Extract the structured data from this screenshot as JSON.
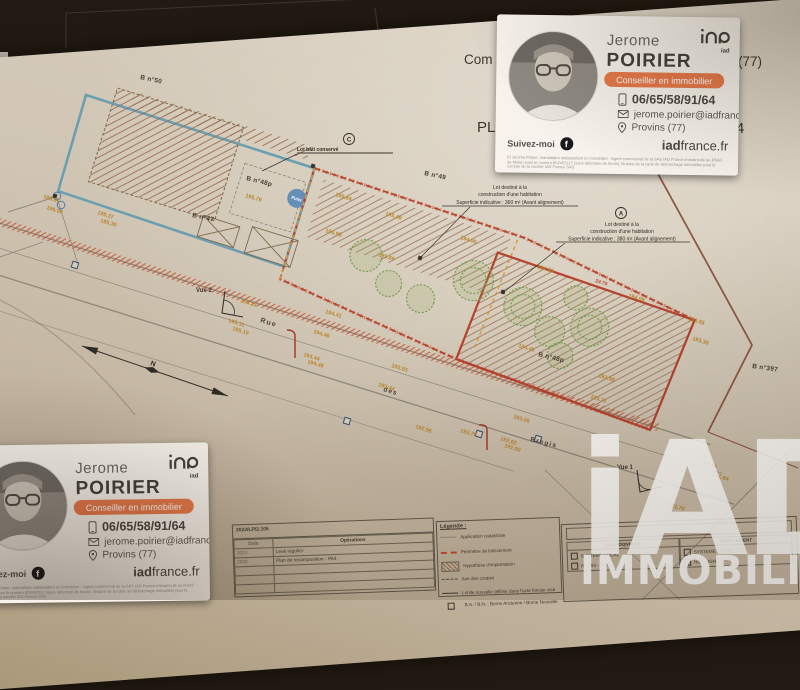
{
  "title_fragments": {
    "com": "Com",
    "dept": "(77)",
    "pl": "PL",
    "num": "4"
  },
  "plan": {
    "parcels": {
      "b50": "B n°50",
      "b47": "B n°47",
      "b48p_left": "B n°48p",
      "b49": "B n°49",
      "b48p_right": "B n°48p",
      "b397": "B n°397"
    },
    "labels": {
      "conserved": "Lot bâti conservé",
      "c_marker": "C",
      "a_marker": "A",
      "lotB1": "Lot destiné à la",
      "lotB2": "construction d'une habitation",
      "lotB3": "Superficie indicative : 360 m² (Avant alignement)",
      "lotA1": "Lot destiné à la",
      "lotA2": "construction d'une habitation",
      "lotA3": "Superficie indicative : 380 m² (Avant alignement)",
      "puits": "Puits",
      "vue1": "Vue 1",
      "vue2": "Vue 2",
      "north": "N",
      "road_rue": "Rue",
      "road_des": "des",
      "road_bregis": "Bregis"
    }
  },
  "measurements": [
    {
      "x": 245,
      "y": 197,
      "v": "195.79"
    },
    {
      "x": 335,
      "y": 196,
      "v": "195.84"
    },
    {
      "x": 385,
      "y": 215,
      "v": "195.49"
    },
    {
      "x": 325,
      "y": 232,
      "v": "195.98"
    },
    {
      "x": 378,
      "y": 256,
      "v": "195.66"
    },
    {
      "x": 460,
      "y": 239,
      "v": "194.90"
    },
    {
      "x": 537,
      "y": 268,
      "v": "194.53"
    },
    {
      "x": 628,
      "y": 297,
      "v": "194.08"
    },
    {
      "x": 240,
      "y": 302,
      "v": "195.13"
    },
    {
      "x": 228,
      "y": 322,
      "v": "195.11"
    },
    {
      "x": 232,
      "y": 330,
      "v": "195.10"
    },
    {
      "x": 325,
      "y": 313,
      "v": "194.41"
    },
    {
      "x": 313,
      "y": 333,
      "v": "194.46"
    },
    {
      "x": 303,
      "y": 356,
      "v": "194.44"
    },
    {
      "x": 307,
      "y": 363,
      "v": "194.49"
    },
    {
      "x": 391,
      "y": 367,
      "v": "193.93"
    },
    {
      "x": 378,
      "y": 386,
      "v": "193.44"
    },
    {
      "x": 518,
      "y": 347,
      "v": "194.45"
    },
    {
      "x": 598,
      "y": 377,
      "v": "193.98"
    },
    {
      "x": 590,
      "y": 398,
      "v": "193.71"
    },
    {
      "x": 460,
      "y": 432,
      "v": "193.76"
    },
    {
      "x": 513,
      "y": 418,
      "v": "193.06"
    },
    {
      "x": 500,
      "y": 440,
      "v": "192.82"
    },
    {
      "x": 504,
      "y": 447,
      "v": "192.90"
    },
    {
      "x": 415,
      "y": 428,
      "v": "192.56"
    },
    {
      "x": 700,
      "y": 464,
      "v": "192.62"
    },
    {
      "x": 712,
      "y": 476,
      "v": "191.84"
    },
    {
      "x": 668,
      "y": 506,
      "v": "191.70"
    },
    {
      "x": 43,
      "y": 198,
      "v": "196.06"
    },
    {
      "x": 46,
      "y": 209,
      "v": "196.00"
    },
    {
      "x": 97,
      "y": 214,
      "v": "195.37"
    },
    {
      "x": 100,
      "y": 222,
      "v": "195.30"
    },
    {
      "x": 688,
      "y": 320,
      "v": "193.55"
    },
    {
      "x": 692,
      "y": 340,
      "v": "193.30"
    },
    {
      "x": 595,
      "y": 282,
      "v": "24.70",
      "red": true
    },
    {
      "x": 552,
      "y": 396,
      "v": "24.62",
      "red": true
    }
  ],
  "titleblock": {
    "ref": "2022/LP/2.105",
    "date_h": "Date",
    "ops_h": "Opérations",
    "d1": "2022",
    "op1": "Levé régulier",
    "d2": "2022",
    "op2": "Plan de recomposition - PA4"
  },
  "legend": {
    "heading": "Légende :",
    "items": [
      {
        "label": "Application cadastrale"
      },
      {
        "label": "Périmètre de lotissement"
      },
      {
        "label": "Hypothèse d'implantation"
      },
      {
        "label": "Axe des coupes"
      },
      {
        "label": "Limite nouvelle définie dans l'acte foncier visé"
      },
      {
        "label": "B.A. / B.N. : Borne Ancienne / Borne Nouvelle"
      }
    ]
  },
  "survey": {
    "header_left": "COORDONNÉES",
    "header_right": "NIVELLEMENT",
    "opt1": "SYSTEME LOCAL",
    "opt2": "RGF93 - CC49",
    "opt3": "SYSTEME LOCAL",
    "opt4": "NGF - IGN69"
  },
  "card": {
    "first_name": "Jerome",
    "last_name": "POIRIER",
    "role": "Conseiller en immobilier",
    "phone": "06/65/58/91/64",
    "email": "jerome.poirier@iadfrance.fr",
    "location": "Provins (77)",
    "follow": "Suivez-moi",
    "facebook": "f",
    "website_bold": "iad",
    "website_rest": "france.fr",
    "logo_sub": "iad",
    "legal": "El Jerome Poirier, mandataire indépendant en immobilier - Agent commercial de la SAS IAD France immatriculé au RSAC de Melun sous le numéro 802452117 (sans détention de fonds), titulaire de la carte de démarchage immobilier pour le compte de la société IAD France SAS."
  },
  "watermark": {
    "line1": "iAD",
    "line2": "IMMOBILIER"
  },
  "colors": {
    "accent_orange": "#e8794a",
    "lot_blue": "#6b9fb0",
    "perimeter_red": "#b5432f",
    "measure": "#b8862e"
  }
}
